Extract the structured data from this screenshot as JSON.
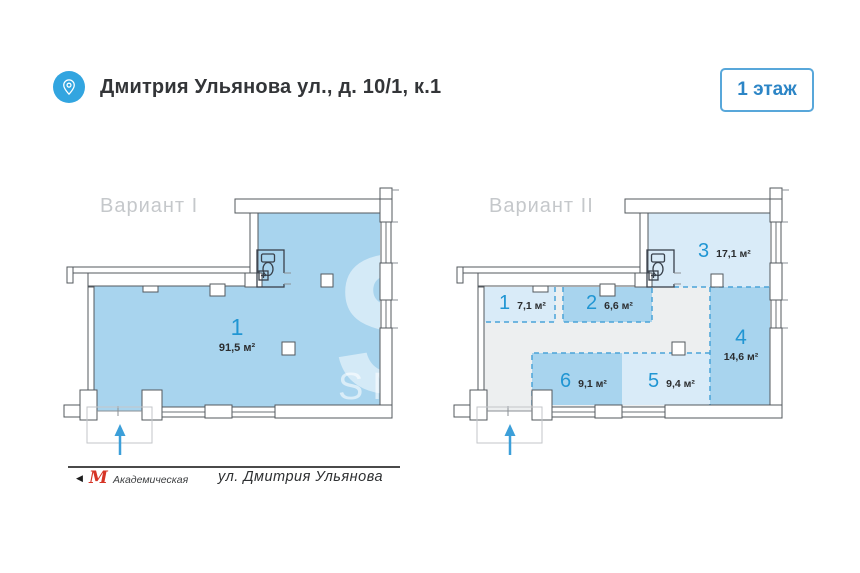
{
  "header": {
    "title": "Дмитрия Ульянова ул., д. 10/1, к.1",
    "floor_badge": "1 этаж"
  },
  "plans": {
    "variant1": {
      "label": "Вариант I",
      "rooms": [
        {
          "number": "1",
          "area": "91,5 м²"
        }
      ]
    },
    "variant2": {
      "label": "Вариант II",
      "rooms": [
        {
          "number": "1",
          "area": "7,1 м²"
        },
        {
          "number": "2",
          "area": "6,6 м²"
        },
        {
          "number": "3",
          "area": "17,1 м²"
        },
        {
          "number": "4",
          "area": "14,6 м²"
        },
        {
          "number": "5",
          "area": "9,4 м²"
        },
        {
          "number": "6",
          "area": "9,1 м²"
        }
      ]
    }
  },
  "watermark": {
    "big_letter": "S",
    "fragment_1": "E",
    "fragment_2": "H",
    "text": "SMARENKA"
  },
  "footer": {
    "metro_logo": "М",
    "metro_station": "Академическая",
    "street": "ул. Дмитрия Ульянова"
  },
  "colors": {
    "accent_blue": "#2196d3",
    "room_blue": "#a8d4ee",
    "room_light_blue": "#d9ebf8",
    "common_gray": "#edeff0",
    "wall_stroke": "#53585e",
    "dashed_partition": "#4aa3d8",
    "badge_border": "#58a7da",
    "metro_red": "#d63426"
  }
}
